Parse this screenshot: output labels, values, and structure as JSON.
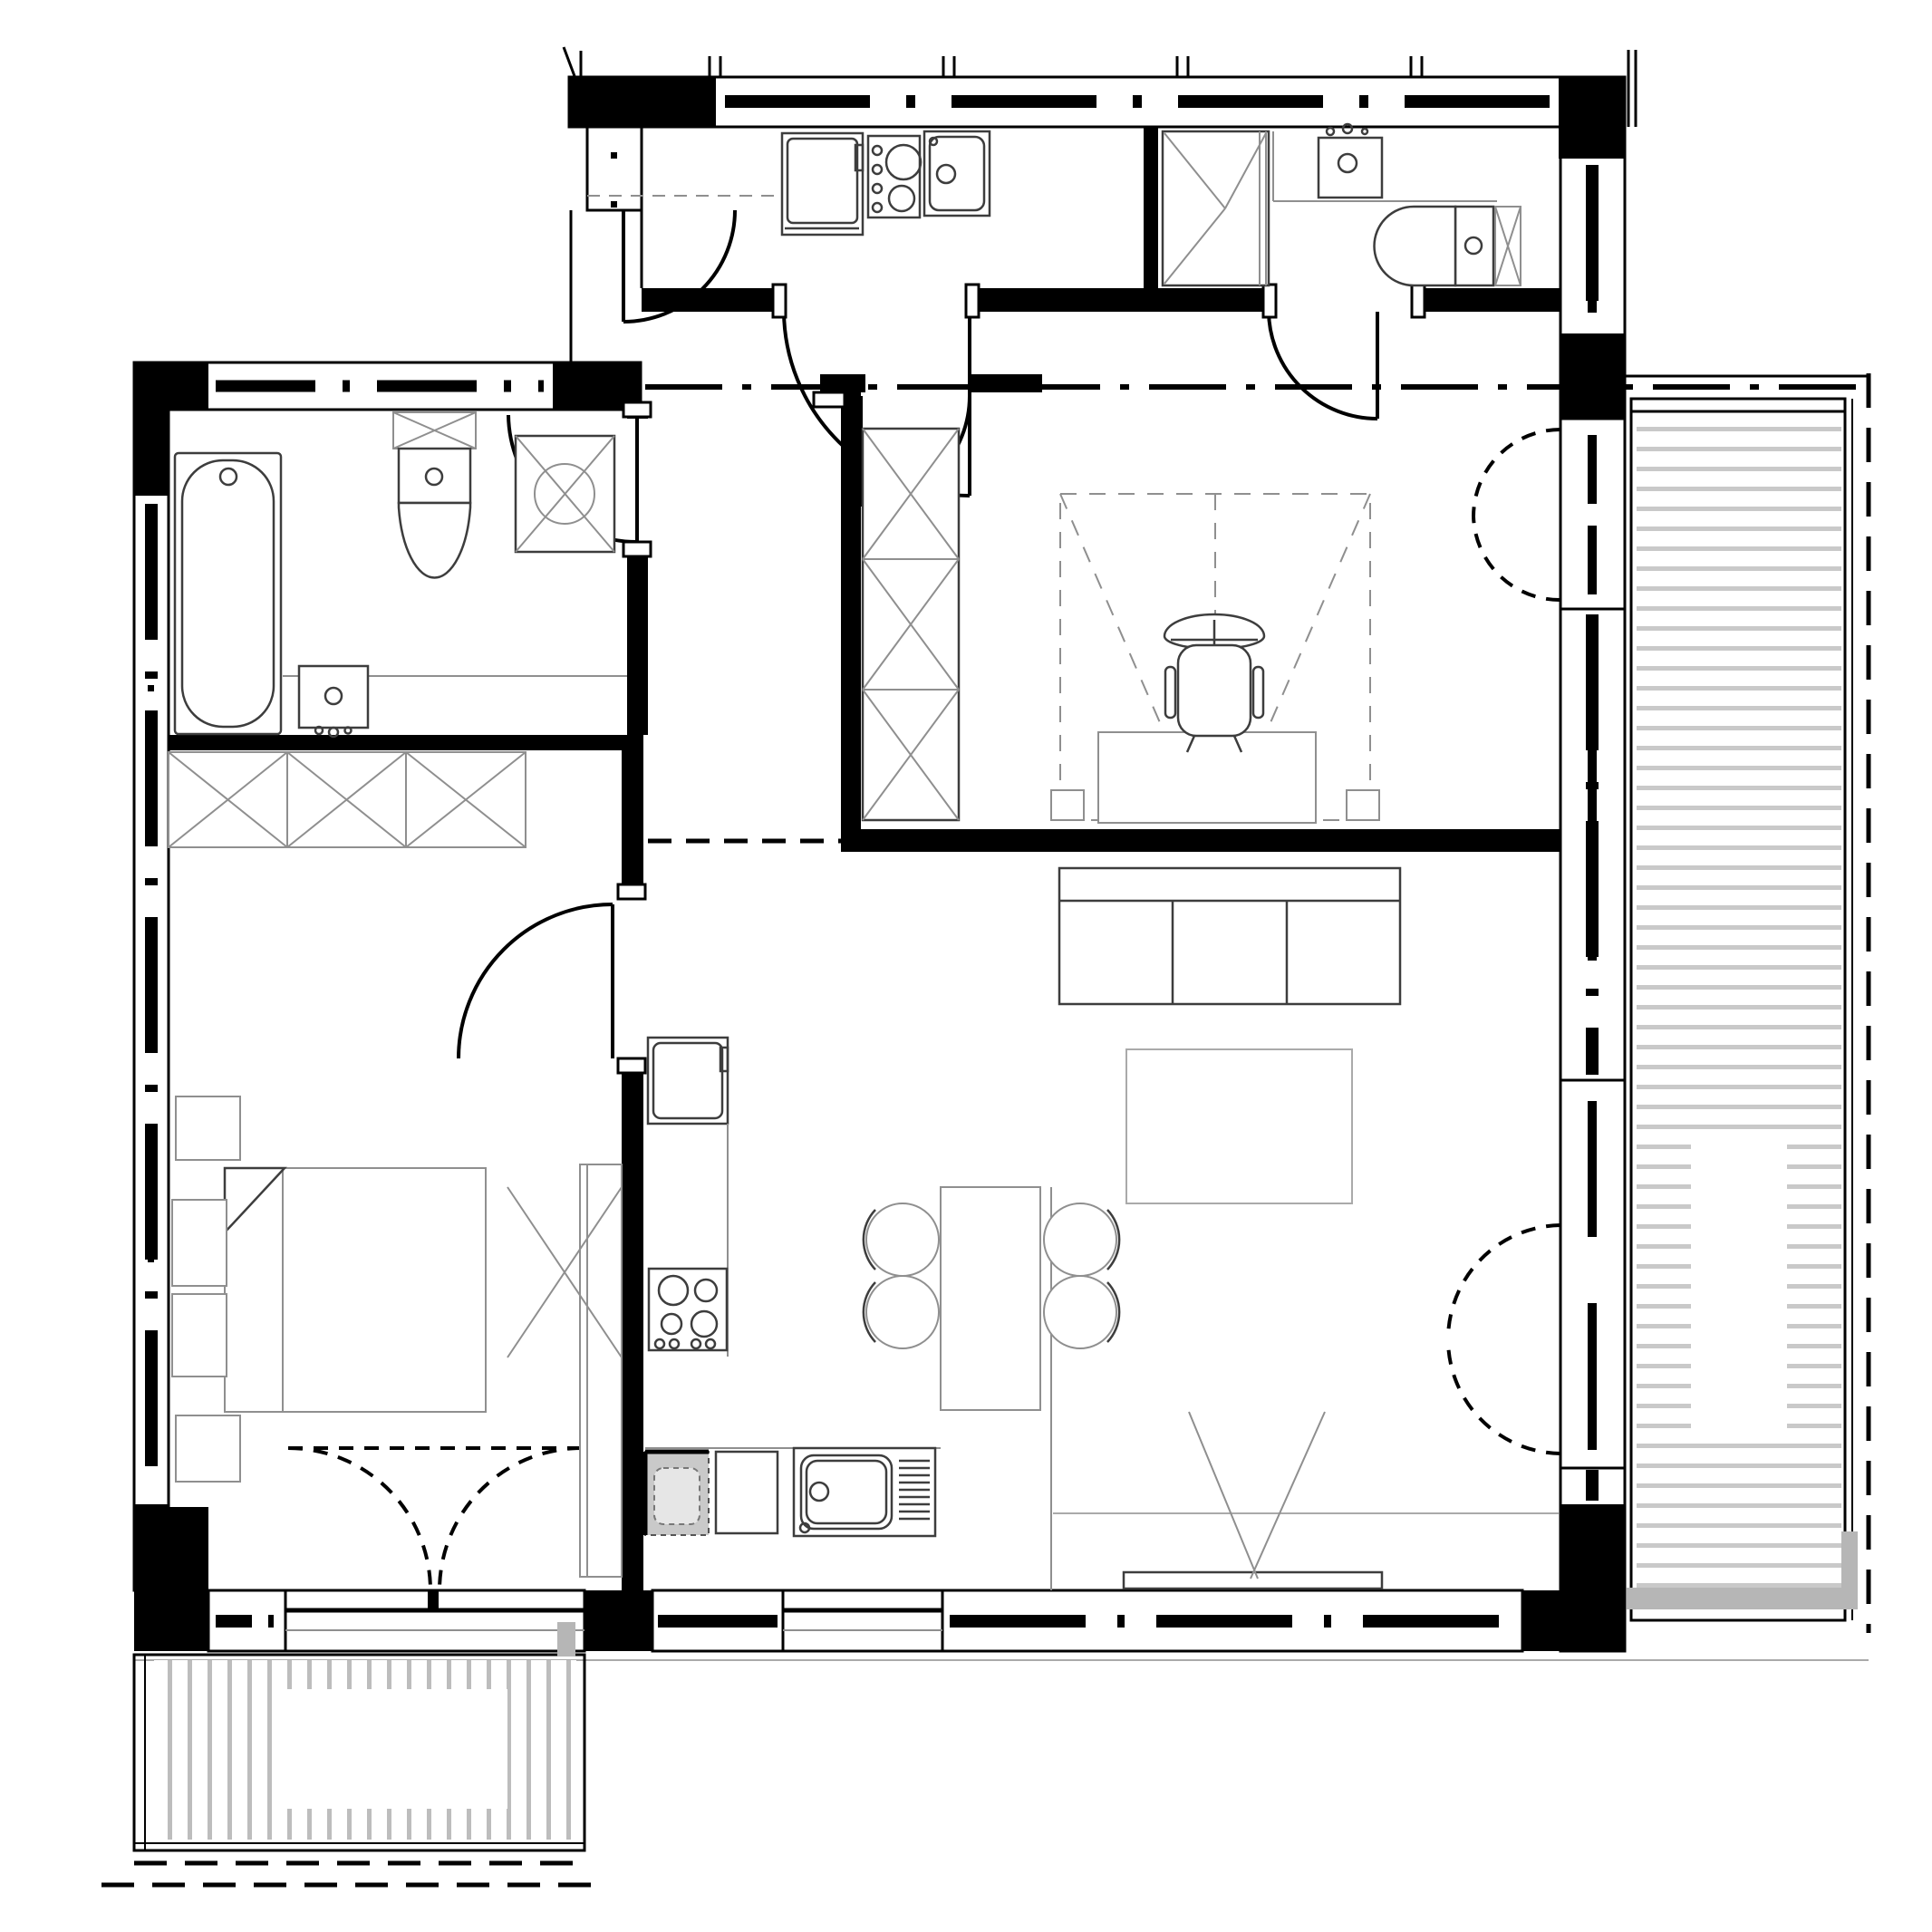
{
  "meta": {
    "title": "apartment-floor-plan",
    "drawing_style": "black-white-architectural-cad",
    "text_labels_visible": "none"
  },
  "colors": {
    "ink": "#000000",
    "wallGray": "#7b7b7b",
    "deckLine": "#c9c9c9",
    "lightBand": "#b6b6b6",
    "thin": "#8f8f8f",
    "faint": "#aaaaaa",
    "furn": "#3d3d3d",
    "paper": "#ffffff"
  },
  "rooms": [
    {
      "id": "entry-hall",
      "fixtures": [
        "entry-door",
        "corridor-dash-dot-line"
      ]
    },
    {
      "id": "utility-kitchenette",
      "fixtures": [
        "washing-machine",
        "hob-2-burner",
        "sink",
        "door-to-hall"
      ]
    },
    {
      "id": "bathroom-top",
      "fixtures": [
        "shower-tray",
        "washbasin",
        "toilet",
        "service-duct-x",
        "door-to-hall"
      ]
    },
    {
      "id": "bathroom-left",
      "fixtures": [
        "bathtub",
        "concealed-cistern-x",
        "toilet",
        "shower-with-circle",
        "washbasin-on-counter",
        "door"
      ]
    },
    {
      "id": "bedroom-study",
      "fixtures": [
        "wardrobe-3-sections-x",
        "fold-down-bed-dashed-zone",
        "desk",
        "office-chair",
        "bed-feet",
        "balcony-french-door-double-dashed"
      ]
    },
    {
      "id": "living-room",
      "fixtures": [
        "sofa-3-seat",
        "coffee-table",
        "tv-on-lowboard",
        "balcony-french-door-dashed"
      ]
    },
    {
      "id": "kitchen-dining",
      "fixtures": [
        "tall-cabinet-fridge",
        "cooktop-4-burner-with-knobs",
        "dishwasher-hatched",
        "base-cabinet",
        "sink-with-drainboard",
        "island-table",
        "dining-chairs"
      ]
    },
    {
      "id": "bedroom-left",
      "fixtures": [
        "wardrobe-3-sections-x",
        "double-bed",
        "pillows",
        "nightstand-top",
        "nightstand-bottom",
        "tall-wardrobe-x",
        "french-door-double-dashed"
      ]
    },
    {
      "id": "balcony-right",
      "fixtures": [
        "decking-horizontal-strips",
        "railing",
        "property-dashed-line"
      ]
    },
    {
      "id": "balcony-left",
      "fixtures": [
        "decking-vertical-strips",
        "railing",
        "property-dashed-line"
      ]
    }
  ],
  "counts": {
    "bedrooms": 2,
    "bathrooms": 2,
    "balconies": 2,
    "dining_chairs": 4,
    "sofa_seats": 3,
    "kitchen_hob_burners": 4,
    "utility_hob_burners": 2,
    "wardrobe_sections_per_unit": 3
  }
}
